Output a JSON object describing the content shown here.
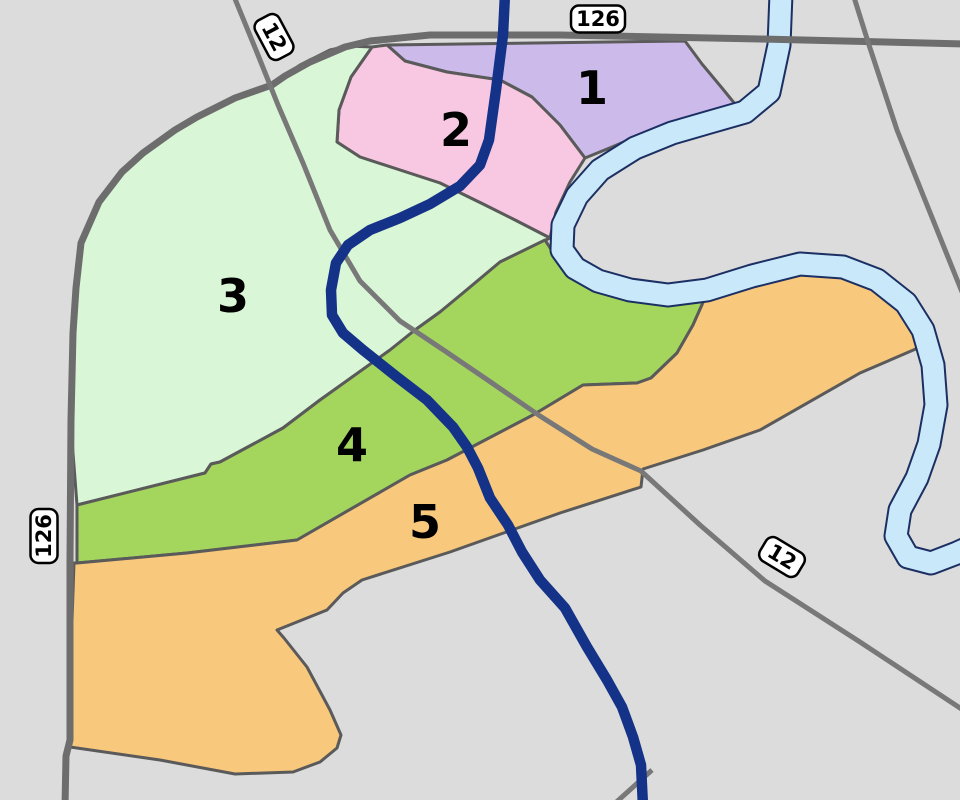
{
  "map": {
    "background_color": "#dcdcdc",
    "boundary_color": "#5a5a5a",
    "boundary_width": 3,
    "label_color": "#000000",
    "label_font_size": 46,
    "zones": [
      {
        "id": "1",
        "label": "1",
        "fill": "#ccbaeb",
        "label_x": 592,
        "label_y": 88,
        "points": [
          [
            387,
            45
          ],
          [
            685,
            41
          ],
          [
            702,
            64
          ],
          [
            722,
            88
          ],
          [
            735,
            104
          ],
          [
            698,
            117
          ],
          [
            652,
            130
          ],
          [
            612,
            147
          ],
          [
            585,
            158
          ],
          [
            560,
            125
          ],
          [
            532,
            97
          ],
          [
            500,
            80
          ],
          [
            447,
            72
          ],
          [
            405,
            61
          ]
        ]
      },
      {
        "id": "2",
        "label": "2",
        "fill": "#f8c8e2",
        "label_x": 456,
        "label_y": 130,
        "points": [
          [
            372,
            47
          ],
          [
            387,
            45
          ],
          [
            405,
            61
          ],
          [
            447,
            72
          ],
          [
            500,
            80
          ],
          [
            532,
            97
          ],
          [
            560,
            125
          ],
          [
            585,
            158
          ],
          [
            570,
            182
          ],
          [
            556,
            212
          ],
          [
            550,
            238
          ],
          [
            515,
            220
          ],
          [
            483,
            204
          ],
          [
            440,
            183
          ],
          [
            400,
            170
          ],
          [
            360,
            157
          ],
          [
            337,
            142
          ],
          [
            339,
            110
          ],
          [
            351,
            77
          ]
        ]
      },
      {
        "id": "3",
        "label": "3",
        "fill": "#d9f6d6",
        "label_x": 233,
        "label_y": 296,
        "points": [
          [
            272,
            85
          ],
          [
            300,
            65
          ],
          [
            330,
            50
          ],
          [
            348,
            46
          ],
          [
            372,
            47
          ],
          [
            351,
            77
          ],
          [
            339,
            110
          ],
          [
            337,
            142
          ],
          [
            360,
            157
          ],
          [
            400,
            170
          ],
          [
            440,
            183
          ],
          [
            483,
            204
          ],
          [
            515,
            220
          ],
          [
            550,
            238
          ],
          [
            500,
            262
          ],
          [
            463,
            293
          ],
          [
            440,
            312
          ],
          [
            415,
            330
          ],
          [
            390,
            350
          ],
          [
            320,
            400
          ],
          [
            283,
            428
          ],
          [
            220,
            462
          ],
          [
            211,
            464
          ],
          [
            205,
            473
          ],
          [
            77,
            505
          ],
          [
            72,
            440
          ],
          [
            72,
            380
          ],
          [
            73,
            333
          ],
          [
            76,
            288
          ],
          [
            81,
            243
          ],
          [
            99,
            202
          ],
          [
            122,
            172
          ],
          [
            143,
            153
          ],
          [
            175,
            130
          ],
          [
            197,
            117
          ],
          [
            235,
            98
          ]
        ]
      },
      {
        "id": "4",
        "label": "4",
        "fill": "#a4d65e",
        "label_x": 352,
        "label_y": 445,
        "points": [
          [
            545,
            240
          ],
          [
            560,
            263
          ],
          [
            588,
            279
          ],
          [
            622,
            290
          ],
          [
            662,
            296
          ],
          [
            705,
            298
          ],
          [
            693,
            325
          ],
          [
            677,
            353
          ],
          [
            651,
            378
          ],
          [
            637,
            383
          ],
          [
            583,
            385
          ],
          [
            533,
            415
          ],
          [
            447,
            460
          ],
          [
            410,
            475
          ],
          [
            297,
            540
          ],
          [
            187,
            553
          ],
          [
            77,
            563
          ],
          [
            77,
            505
          ],
          [
            205,
            473
          ],
          [
            211,
            464
          ],
          [
            220,
            462
          ],
          [
            283,
            428
          ],
          [
            320,
            400
          ],
          [
            390,
            350
          ],
          [
            415,
            330
          ],
          [
            440,
            312
          ],
          [
            463,
            293
          ],
          [
            500,
            262
          ]
        ]
      },
      {
        "id": "5",
        "label": "5",
        "fill": "#f8c87d",
        "label_x": 425,
        "label_y": 522,
        "points": [
          [
            77,
            563
          ],
          [
            187,
            553
          ],
          [
            297,
            540
          ],
          [
            410,
            475
          ],
          [
            447,
            460
          ],
          [
            533,
            415
          ],
          [
            583,
            385
          ],
          [
            637,
            383
          ],
          [
            651,
            378
          ],
          [
            677,
            353
          ],
          [
            693,
            325
          ],
          [
            705,
            298
          ],
          [
            757,
            279
          ],
          [
            803,
            267
          ],
          [
            845,
            270
          ],
          [
            878,
            283
          ],
          [
            903,
            305
          ],
          [
            918,
            330
          ],
          [
            925,
            345
          ],
          [
            860,
            373
          ],
          [
            760,
            430
          ],
          [
            703,
            450
          ],
          [
            643,
            469
          ],
          [
            641,
            487
          ],
          [
            560,
            513
          ],
          [
            450,
            552
          ],
          [
            362,
            580
          ],
          [
            343,
            593
          ],
          [
            327,
            610
          ],
          [
            277,
            630
          ],
          [
            284,
            638
          ],
          [
            307,
            667
          ],
          [
            330,
            710
          ],
          [
            341,
            735
          ],
          [
            337,
            748
          ],
          [
            320,
            762
          ],
          [
            293,
            772
          ],
          [
            235,
            774
          ],
          [
            160,
            760
          ],
          [
            70,
            747
          ],
          [
            71,
            650
          ],
          [
            74,
            563
          ]
        ]
      }
    ],
    "river": {
      "name": "river",
      "fill": "#c9e8fa",
      "outline": "#1c2f63",
      "width": 21,
      "outline_extra": 4,
      "points": [
        [
          781,
          -6
        ],
        [
          779,
          45
        ],
        [
          769,
          92
        ],
        [
          745,
          112
        ],
        [
          710,
          122
        ],
        [
          672,
          133
        ],
        [
          635,
          148
        ],
        [
          600,
          170
        ],
        [
          577,
          196
        ],
        [
          563,
          225
        ],
        [
          562,
          250
        ],
        [
          575,
          268
        ],
        [
          598,
          281
        ],
        [
          630,
          290
        ],
        [
          668,
          295
        ],
        [
          707,
          290
        ],
        [
          752,
          276
        ],
        [
          800,
          264
        ],
        [
          843,
          267
        ],
        [
          877,
          280
        ],
        [
          906,
          303
        ],
        [
          923,
          330
        ],
        [
          933,
          365
        ],
        [
          936,
          405
        ],
        [
          929,
          444
        ],
        [
          917,
          478
        ],
        [
          900,
          510
        ],
        [
          896,
          536
        ],
        [
          908,
          557
        ],
        [
          931,
          563
        ],
        [
          957,
          553
        ],
        [
          966,
          549
        ]
      ]
    },
    "roads": [
      {
        "name": "route-126-road",
        "color": "#6d6d6d",
        "width": 7,
        "points": [
          [
            966,
            44
          ],
          [
            760,
            39
          ],
          [
            560,
            35
          ],
          [
            430,
            35
          ],
          [
            370,
            41
          ],
          [
            345,
            47
          ],
          [
            310,
            62
          ],
          [
            285,
            76
          ],
          [
            272,
            85
          ],
          [
            235,
            98
          ],
          [
            197,
            117
          ],
          [
            175,
            130
          ],
          [
            143,
            153
          ],
          [
            122,
            172
          ],
          [
            99,
            202
          ],
          [
            81,
            243
          ],
          [
            76,
            288
          ],
          [
            73,
            333
          ],
          [
            71,
            420
          ],
          [
            70,
            560
          ],
          [
            70,
            740
          ],
          [
            66,
            756
          ],
          [
            65,
            806
          ]
        ]
      },
      {
        "name": "route-12-road",
        "color": "#787878",
        "width": 5,
        "points": [
          [
            233,
            -6
          ],
          [
            258,
            55
          ],
          [
            278,
            105
          ],
          [
            303,
            163
          ],
          [
            330,
            230
          ],
          [
            360,
            281
          ],
          [
            400,
            321
          ],
          [
            445,
            351
          ],
          [
            492,
            383
          ],
          [
            540,
            416
          ],
          [
            592,
            449
          ],
          [
            641,
            471
          ],
          [
            700,
            525
          ],
          [
            765,
            581
          ],
          [
            860,
            642
          ],
          [
            966,
            712
          ]
        ]
      },
      {
        "name": "northeast-diagonal-road",
        "color": "#787878",
        "width": 5,
        "points": [
          [
            853,
            -6
          ],
          [
            869,
            45
          ],
          [
            897,
            130
          ],
          [
            925,
            200
          ],
          [
            962,
            292
          ]
        ]
      },
      {
        "name": "bottom-road-stub",
        "color": "#787878",
        "width": 5,
        "points": [
          [
            612,
            806
          ],
          [
            652,
            770
          ]
        ]
      }
    ],
    "blue_line": {
      "name": "blue-route-line",
      "color": "#143287",
      "width": 10.5,
      "points": [
        [
          505,
          -6
        ],
        [
          503,
          35
        ],
        [
          496,
          90
        ],
        [
          489,
          140
        ],
        [
          480,
          165
        ],
        [
          460,
          186
        ],
        [
          430,
          204
        ],
        [
          400,
          218
        ],
        [
          370,
          230
        ],
        [
          348,
          245
        ],
        [
          336,
          263
        ],
        [
          331,
          290
        ],
        [
          332,
          315
        ],
        [
          343,
          333
        ],
        [
          363,
          350
        ],
        [
          397,
          377
        ],
        [
          427,
          400
        ],
        [
          453,
          427
        ],
        [
          467,
          447
        ],
        [
          478,
          468
        ],
        [
          490,
          498
        ],
        [
          508,
          525
        ],
        [
          522,
          552
        ],
        [
          540,
          580
        ],
        [
          565,
          608
        ],
        [
          587,
          647
        ],
        [
          607,
          680
        ],
        [
          622,
          707
        ],
        [
          633,
          737
        ],
        [
          641,
          765
        ],
        [
          643,
          806
        ]
      ]
    },
    "shields": [
      {
        "text": "126",
        "x": 598,
        "y": 19,
        "rotation": 0,
        "w": 54,
        "h": 27
      },
      {
        "text": "12",
        "x": 274,
        "y": 37,
        "rotation": 62,
        "w": 44,
        "h": 27
      },
      {
        "text": "126",
        "x": 44,
        "y": 536,
        "rotation": -90,
        "w": 54,
        "h": 27
      },
      {
        "text": "12",
        "x": 782,
        "y": 557,
        "rotation": 31,
        "w": 44,
        "h": 27
      }
    ],
    "shield_style": {
      "fill": "#ffffff",
      "stroke": "#000000",
      "stroke_width": 2.5,
      "radius": 8,
      "font_size": 21,
      "text_color": "#000000"
    }
  }
}
